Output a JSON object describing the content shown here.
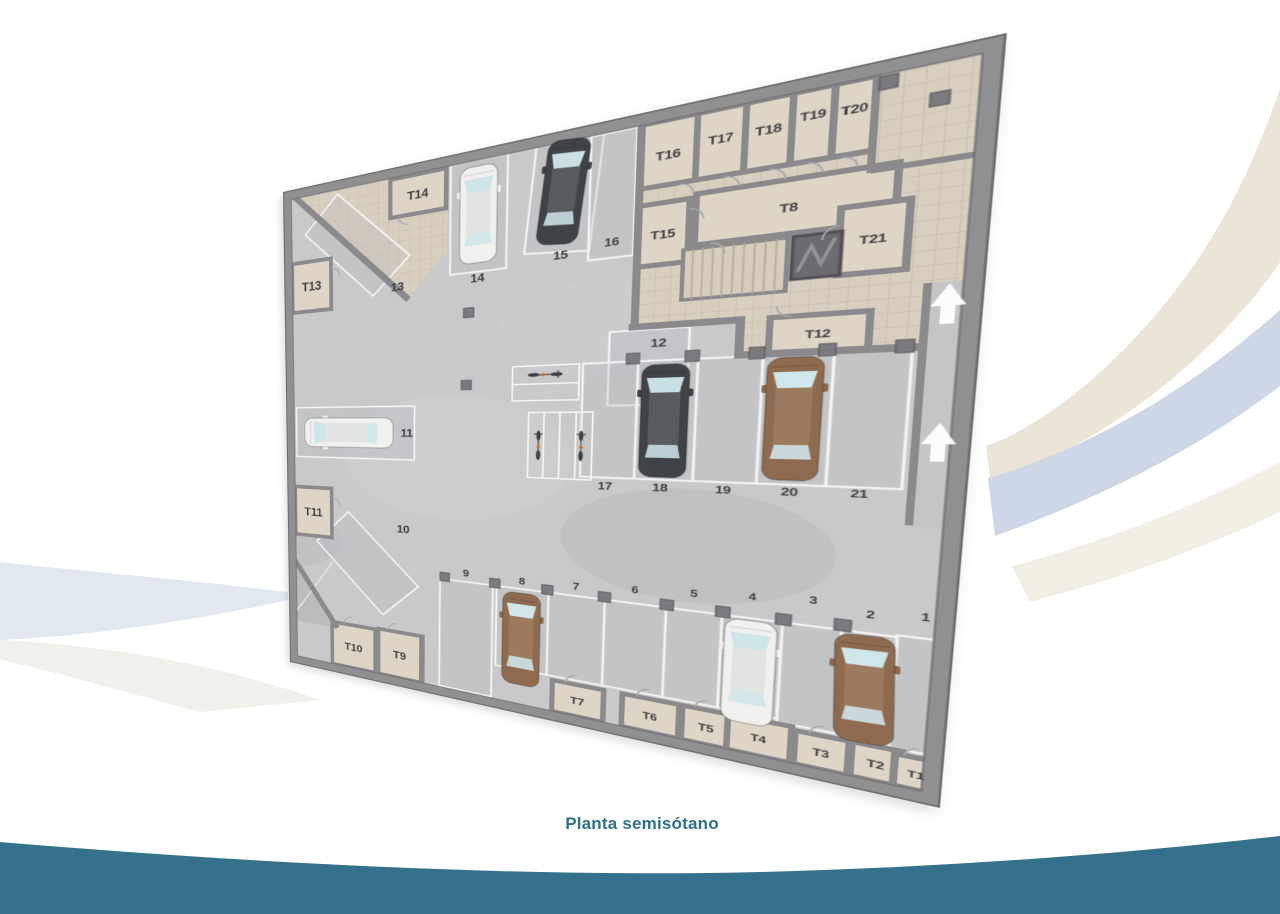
{
  "title": {
    "text": "Planta semisótano"
  },
  "colors": {
    "accent_teal": "#2e7086",
    "band_teal": "#35718c",
    "ribbon_beige": "#ebe5d7",
    "ribbon_blue": "#cdd7e5",
    "wall": "#8e8e90",
    "parking_floor": "#c9c9cb",
    "storage_floor": "#d8cfc0",
    "room_floor": "#ded5c6",
    "stall_line": "#f4f4f4",
    "label": "#3f3f41",
    "arrow": "#ffffff"
  },
  "plan": {
    "parking_spots": [
      {
        "label": "1",
        "x": 719,
        "y": 576,
        "fs": 12
      },
      {
        "label": "2",
        "x": 679,
        "y": 580,
        "fs": 12
      },
      {
        "label": "3",
        "x": 634,
        "y": 571,
        "fs": 12
      },
      {
        "label": "4",
        "x": 583,
        "y": 575,
        "fs": 12
      },
      {
        "label": "5",
        "x": 530,
        "y": 579,
        "fs": 13
      },
      {
        "label": "6",
        "x": 472,
        "y": 583,
        "fs": 13
      },
      {
        "label": "7",
        "x": 409,
        "y": 588,
        "fs": 14
      },
      {
        "label": "8",
        "x": 346,
        "y": 590,
        "fs": 14
      },
      {
        "label": "9",
        "x": 275,
        "y": 588,
        "fs": 15
      },
      {
        "label": "10",
        "x": 187,
        "y": 532,
        "fs": 17
      },
      {
        "label": "11",
        "x": 192,
        "y": 386,
        "fs": 17
      },
      {
        "label": "12",
        "x": 486,
        "y": 274,
        "fs": 14
      },
      {
        "label": "13",
        "x": 178,
        "y": 171,
        "fs": 17
      },
      {
        "label": "14",
        "x": 285,
        "y": 172,
        "fs": 16
      },
      {
        "label": "15",
        "x": 382,
        "y": 155,
        "fs": 15
      },
      {
        "label": "16",
        "x": 436,
        "y": 147,
        "fs": 14
      },
      {
        "label": "17",
        "x": 437,
        "y": 452,
        "fs": 14
      },
      {
        "label": "18",
        "x": 493,
        "y": 451,
        "fs": 14
      },
      {
        "label": "19",
        "x": 552,
        "y": 450,
        "fs": 13
      },
      {
        "label": "20",
        "x": 609,
        "y": 449,
        "fs": 13
      },
      {
        "label": "21",
        "x": 664,
        "y": 448,
        "fs": 12
      }
    ],
    "storage_rooms": [
      {
        "label": "T1",
        "x": 721,
        "y": 750,
        "fs": 11
      },
      {
        "label": "T2",
        "x": 691,
        "y": 748,
        "fs": 12
      },
      {
        "label": "T3",
        "x": 648,
        "y": 748,
        "fs": 12
      },
      {
        "label": "T4",
        "x": 595,
        "y": 746,
        "fs": 12
      },
      {
        "label": "T5",
        "x": 547,
        "y": 746,
        "fs": 13
      },
      {
        "label": "T6",
        "x": 492,
        "y": 746,
        "fs": 13
      },
      {
        "label": "T7",
        "x": 414,
        "y": 746,
        "fs": 14
      },
      {
        "label": "T8",
        "x": 595,
        "y": 135,
        "fs": 13
      },
      {
        "label": "T9",
        "x": 182,
        "y": 731,
        "fs": 17
      },
      {
        "label": "T10",
        "x": 110,
        "y": 733,
        "fs": 17
      },
      {
        "label": "T11",
        "x": 45,
        "y": 517,
        "fs": 19
      },
      {
        "label": "T12",
        "x": 624,
        "y": 274,
        "fs": 12
      },
      {
        "label": "T13",
        "x": 46,
        "y": 155,
        "fs": 19
      },
      {
        "label": "T14",
        "x": 206,
        "y": 45,
        "fs": 17
      },
      {
        "label": "T15",
        "x": 486,
        "y": 146,
        "fs": 14
      },
      {
        "label": "T16",
        "x": 488,
        "y": 55,
        "fs": 14
      },
      {
        "label": "T17",
        "x": 535,
        "y": 48,
        "fs": 13
      },
      {
        "label": "T18",
        "x": 575,
        "y": 48,
        "fs": 13
      },
      {
        "label": "T19",
        "x": 610,
        "y": 42,
        "fs": 12
      },
      {
        "label": "T20",
        "x": 641,
        "y": 44,
        "fs": 12
      },
      {
        "label": "T21",
        "x": 661,
        "y": 179,
        "fs": 12
      }
    ],
    "cars": [
      {
        "spot": "14",
        "type": "white",
        "x": 285,
        "y": 86,
        "rot": 0,
        "len": 128
      },
      {
        "spot": "15",
        "type": "dark",
        "x": 383,
        "y": 76,
        "rot": 6,
        "len": 128
      },
      {
        "spot": "11",
        "type": "white",
        "x": 102,
        "y": 385,
        "rot": -90,
        "len": 140
      },
      {
        "spot": "18",
        "type": "dark",
        "x": 494,
        "y": 368,
        "rot": 0,
        "len": 138
      },
      {
        "spot": "20",
        "type": "brown",
        "x": 608,
        "y": 366,
        "rot": 0,
        "len": 138
      },
      {
        "spot": "8",
        "type": "brown",
        "x": 346,
        "y": 672,
        "rot": 0,
        "len": 132
      },
      {
        "spot": "4",
        "type": "white",
        "x": 583,
        "y": 666,
        "rot": 0,
        "len": 126
      },
      {
        "spot": "2",
        "type": "brown",
        "x": 678,
        "y": 664,
        "rot": -2,
        "len": 122
      }
    ],
    "car_palette": {
      "white": {
        "body": "#f0f1ef",
        "roof": "#e2e4e2",
        "glass": "#cfe4e8"
      },
      "dark": {
        "body": "#3f4246",
        "roof": "#575b5e",
        "glass": "#c9dfe4"
      },
      "brown": {
        "body": "#8e6a4f",
        "roof": "#9c7a5e",
        "glass": "#cfe6ea"
      }
    },
    "bikes": [
      {
        "x": 368,
        "y": 306,
        "rot": 90
      },
      {
        "x": 362,
        "y": 400,
        "rot": 0
      },
      {
        "x": 410,
        "y": 400,
        "rot": 0
      }
    ],
    "ramp_arrows": [
      {
        "x": 717,
        "y": 250
      },
      {
        "x": 718,
        "y": 390
      }
    ]
  }
}
